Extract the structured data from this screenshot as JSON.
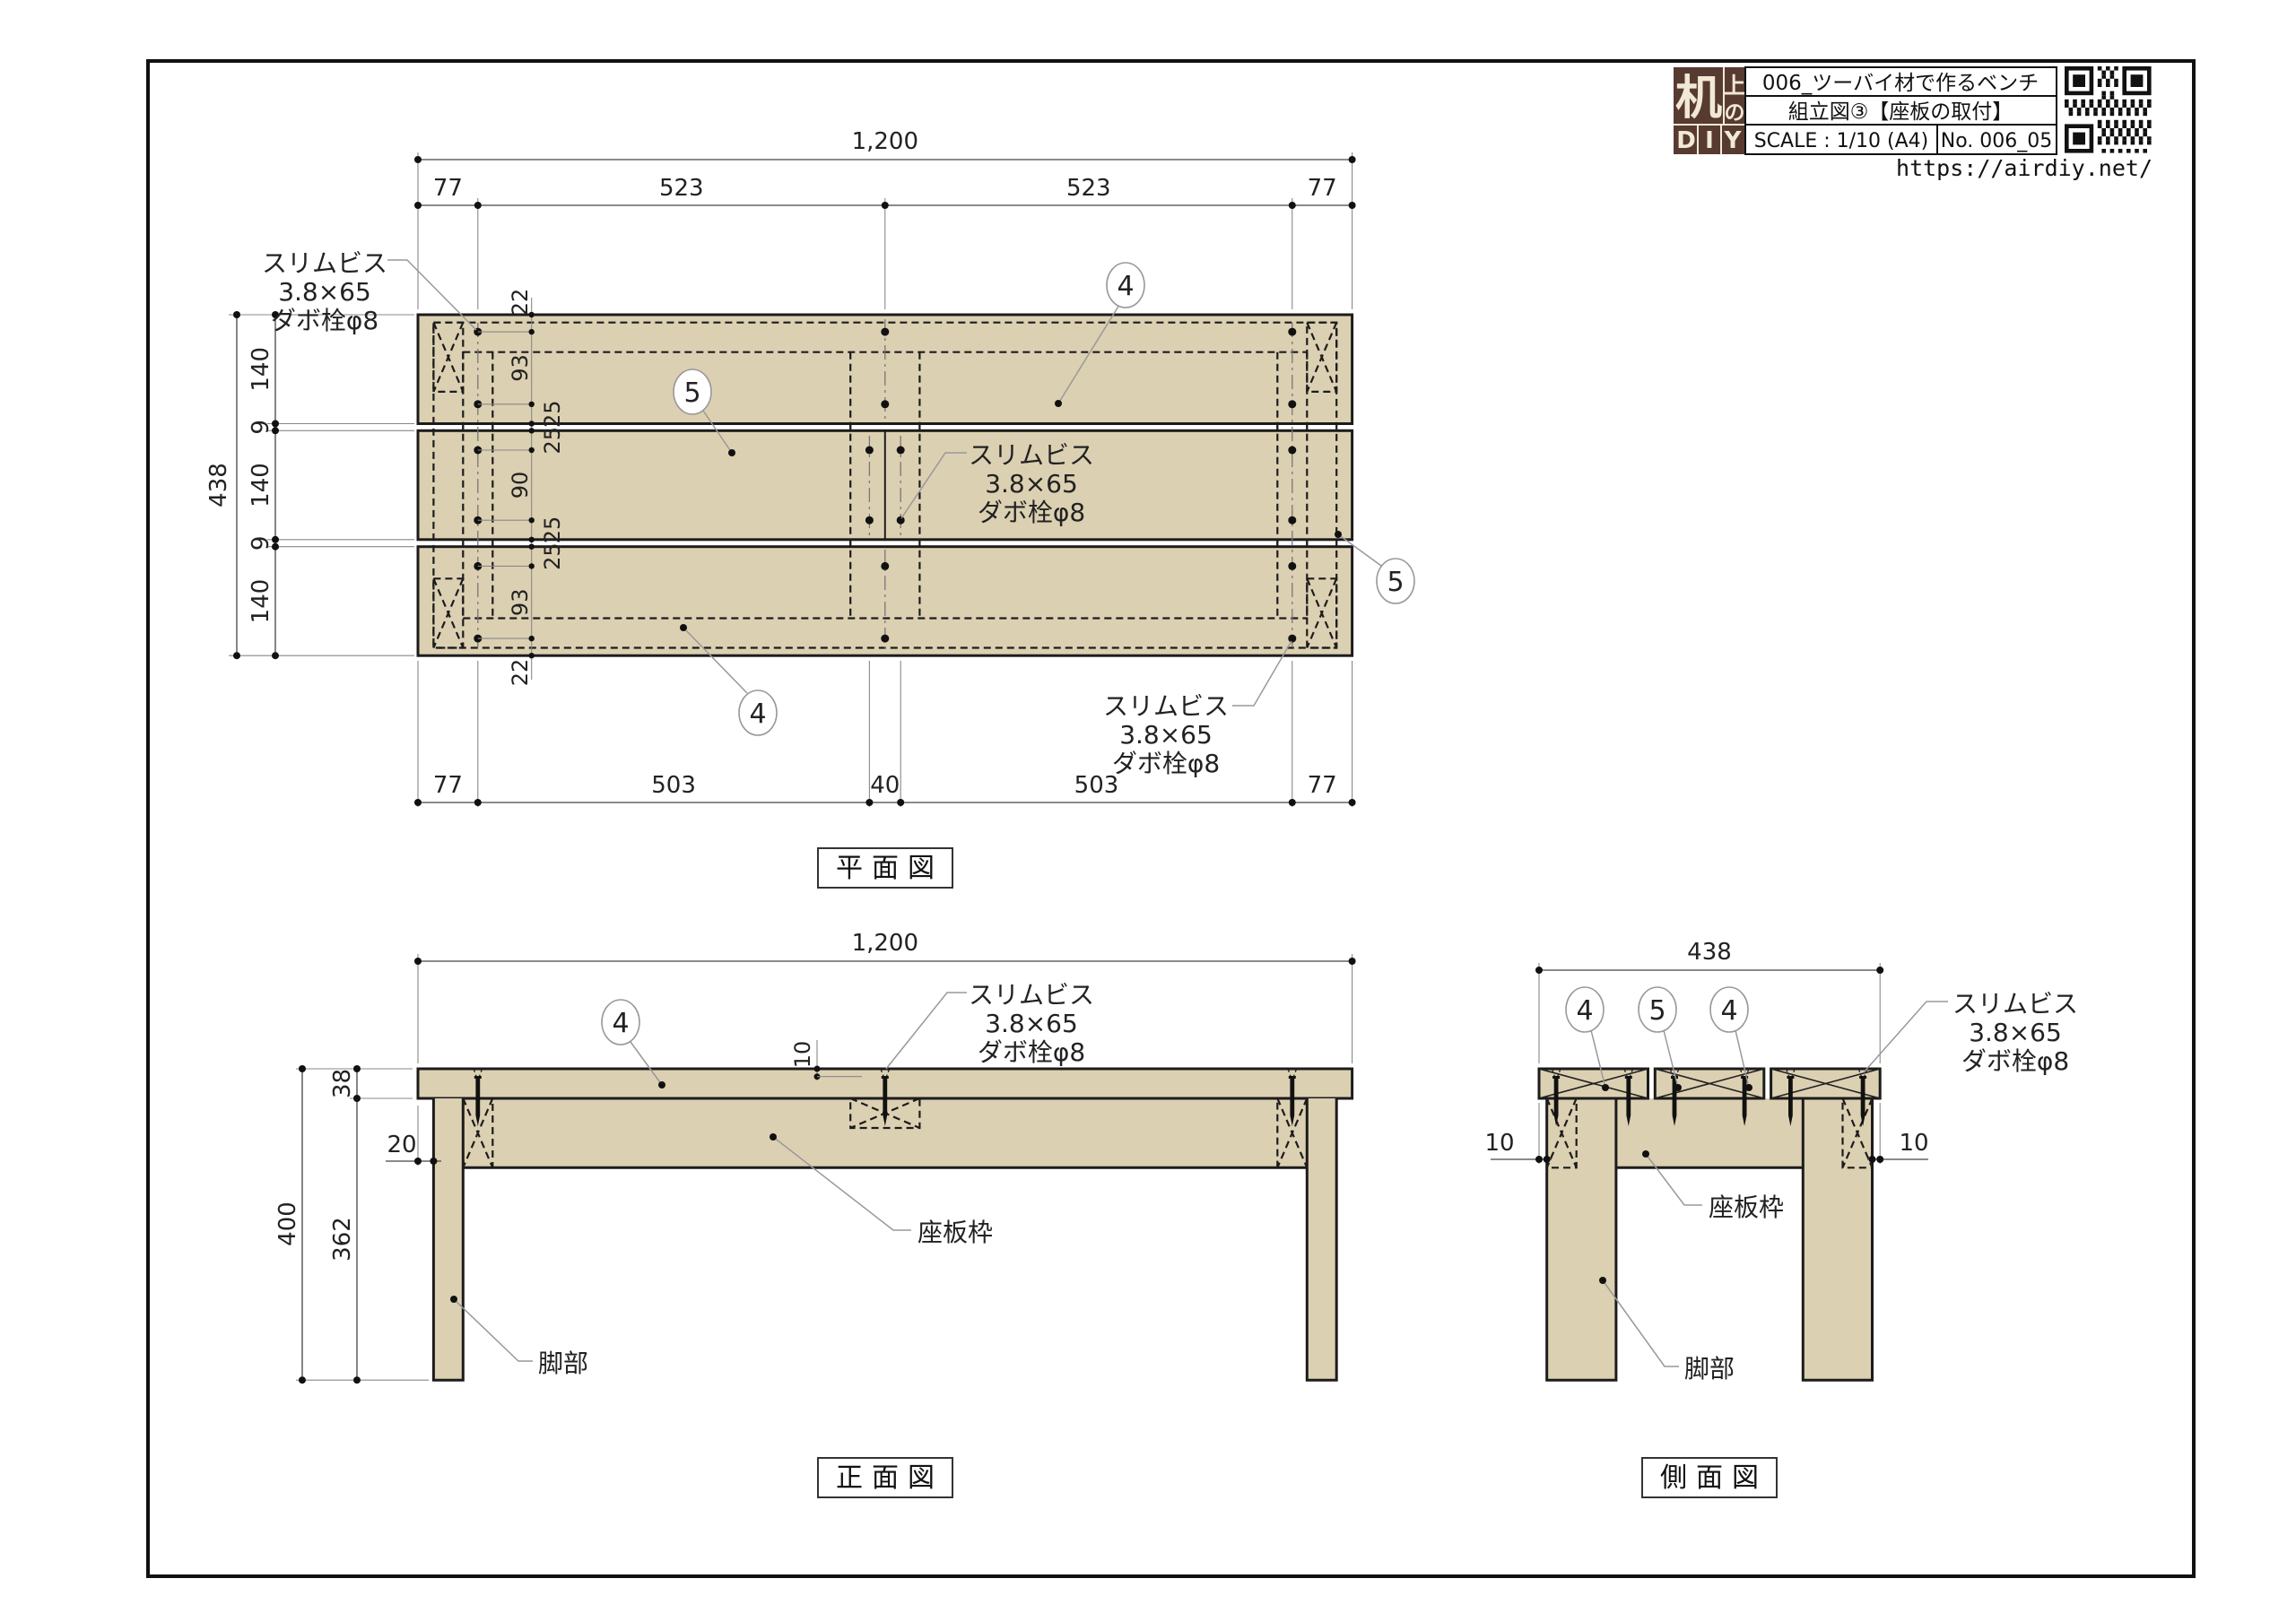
{
  "title_block": {
    "product_title": "006_ツーバイ材で作るベンチ",
    "drawing_title": "組立図③【座板の取付】",
    "scale": "SCALE : 1/10 (A4)",
    "number": "No. 006_05",
    "url": "https://airdiy.net/",
    "logo": {
      "main": "机",
      "top": "上",
      "mid": "の",
      "d": "D",
      "i": "I",
      "y": "Y"
    }
  },
  "views": {
    "plan": {
      "title": "平面図"
    },
    "front": {
      "title": "正面図"
    },
    "side": {
      "title": "側面図"
    }
  },
  "notes": {
    "screw": [
      "スリムビス",
      "3.8×65",
      "ダボ栓φ8"
    ]
  },
  "labels": {
    "seat_frame": "座板枠",
    "leg": "脚部"
  },
  "balloons": {
    "b4": "4",
    "b5": "5"
  },
  "dims": {
    "plan": {
      "total": "1,200",
      "top": [
        "77",
        "523",
        "523",
        "77"
      ],
      "bottom": [
        "77",
        "503",
        "40",
        "503",
        "77"
      ],
      "depth": "438",
      "rows": [
        "140",
        "9",
        "140",
        "9",
        "140"
      ],
      "chain": [
        "22",
        "93",
        "25",
        "25",
        "90",
        "25",
        "25",
        "93",
        "22"
      ]
    },
    "front": {
      "total": "1,200",
      "thickness": "38",
      "height": "400",
      "leg": "362",
      "inset": "20",
      "dowel": "10"
    },
    "side": {
      "total": "438",
      "inset_left": "10",
      "inset_right": "10"
    }
  }
}
